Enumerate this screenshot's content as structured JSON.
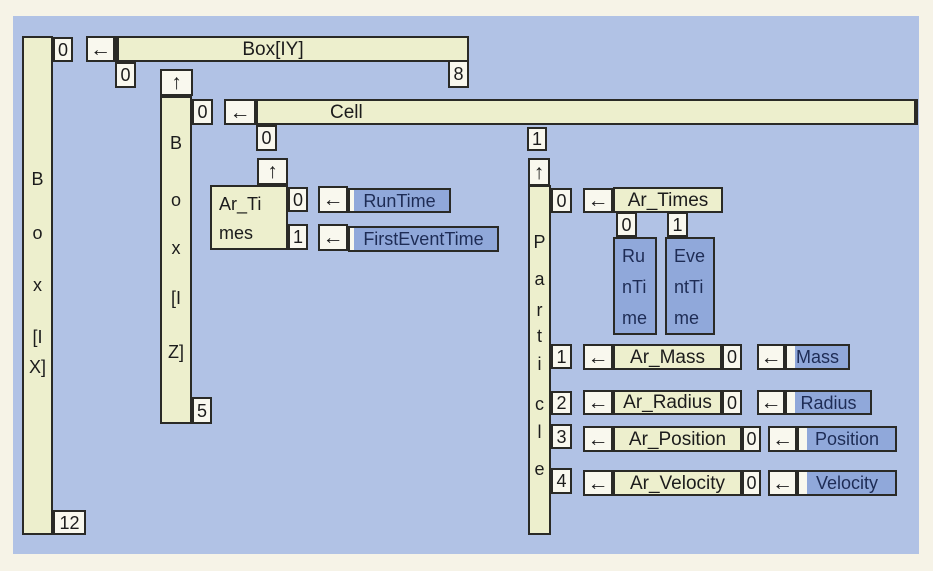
{
  "colors": {
    "page_bg": "#f6f3e7",
    "panel_bg": "#b1c2e5",
    "cream_box": "#edefcd",
    "white_box": "#f9f8ee",
    "blue_box": "#90a8da",
    "border": "#2a2a26",
    "navy_text": "#1e2c55"
  },
  "box_ix": {
    "letters": [
      "B",
      "o",
      "x",
      "[I",
      "X]"
    ],
    "top_index": "0",
    "bottom_index": "12"
  },
  "box_iy": {
    "arrow": "←",
    "label": "Box[IY]",
    "left_index": "0",
    "right_index": "8"
  },
  "box_iz": {
    "arrow_up": "↑",
    "letters": [
      "B",
      "o",
      "x",
      "[I",
      "Z]"
    ],
    "top_index": "0",
    "bottom_index": "5"
  },
  "cell": {
    "arrow": "←",
    "label": "Cell",
    "index_0": "0",
    "index_1": "1"
  },
  "ar_times_cell": {
    "arrow_up": "↑",
    "label_lines": [
      "Ar_Ti",
      "mes"
    ],
    "slots": [
      {
        "index": "0",
        "arrow": "←",
        "target": "RunTime"
      },
      {
        "index": "1",
        "arrow": "←",
        "target": "FirstEventTime"
      }
    ]
  },
  "particle": {
    "arrow_up": "↑",
    "letters": [
      "P",
      "a",
      "r",
      "t",
      "i",
      "c",
      "l",
      "e"
    ],
    "slot0": {
      "index": "0",
      "arrow": "←",
      "label": "Ar_Times",
      "sub_indices": [
        "0",
        "1"
      ],
      "columns": [
        {
          "lines": [
            "Ru",
            "nTi",
            "me"
          ]
        },
        {
          "lines": [
            "Eve",
            "ntTi",
            "me"
          ]
        }
      ]
    },
    "rows": [
      {
        "index": "1",
        "arrow": "←",
        "label": "Ar_Mass",
        "sub_index": "0",
        "arrow2": "←",
        "target": "Mass"
      },
      {
        "index": "2",
        "arrow": "←",
        "label": "Ar_Radius",
        "sub_index": "0",
        "arrow2": "←",
        "target": "Radius"
      },
      {
        "index": "3",
        "arrow": "←",
        "label": "Ar_Position",
        "sub_index": "0",
        "arrow2": "←",
        "target": "Position"
      },
      {
        "index": "4",
        "arrow": "←",
        "label": "Ar_Velocity",
        "sub_index": "0",
        "arrow2": "←",
        "target": "Velocity"
      }
    ]
  }
}
